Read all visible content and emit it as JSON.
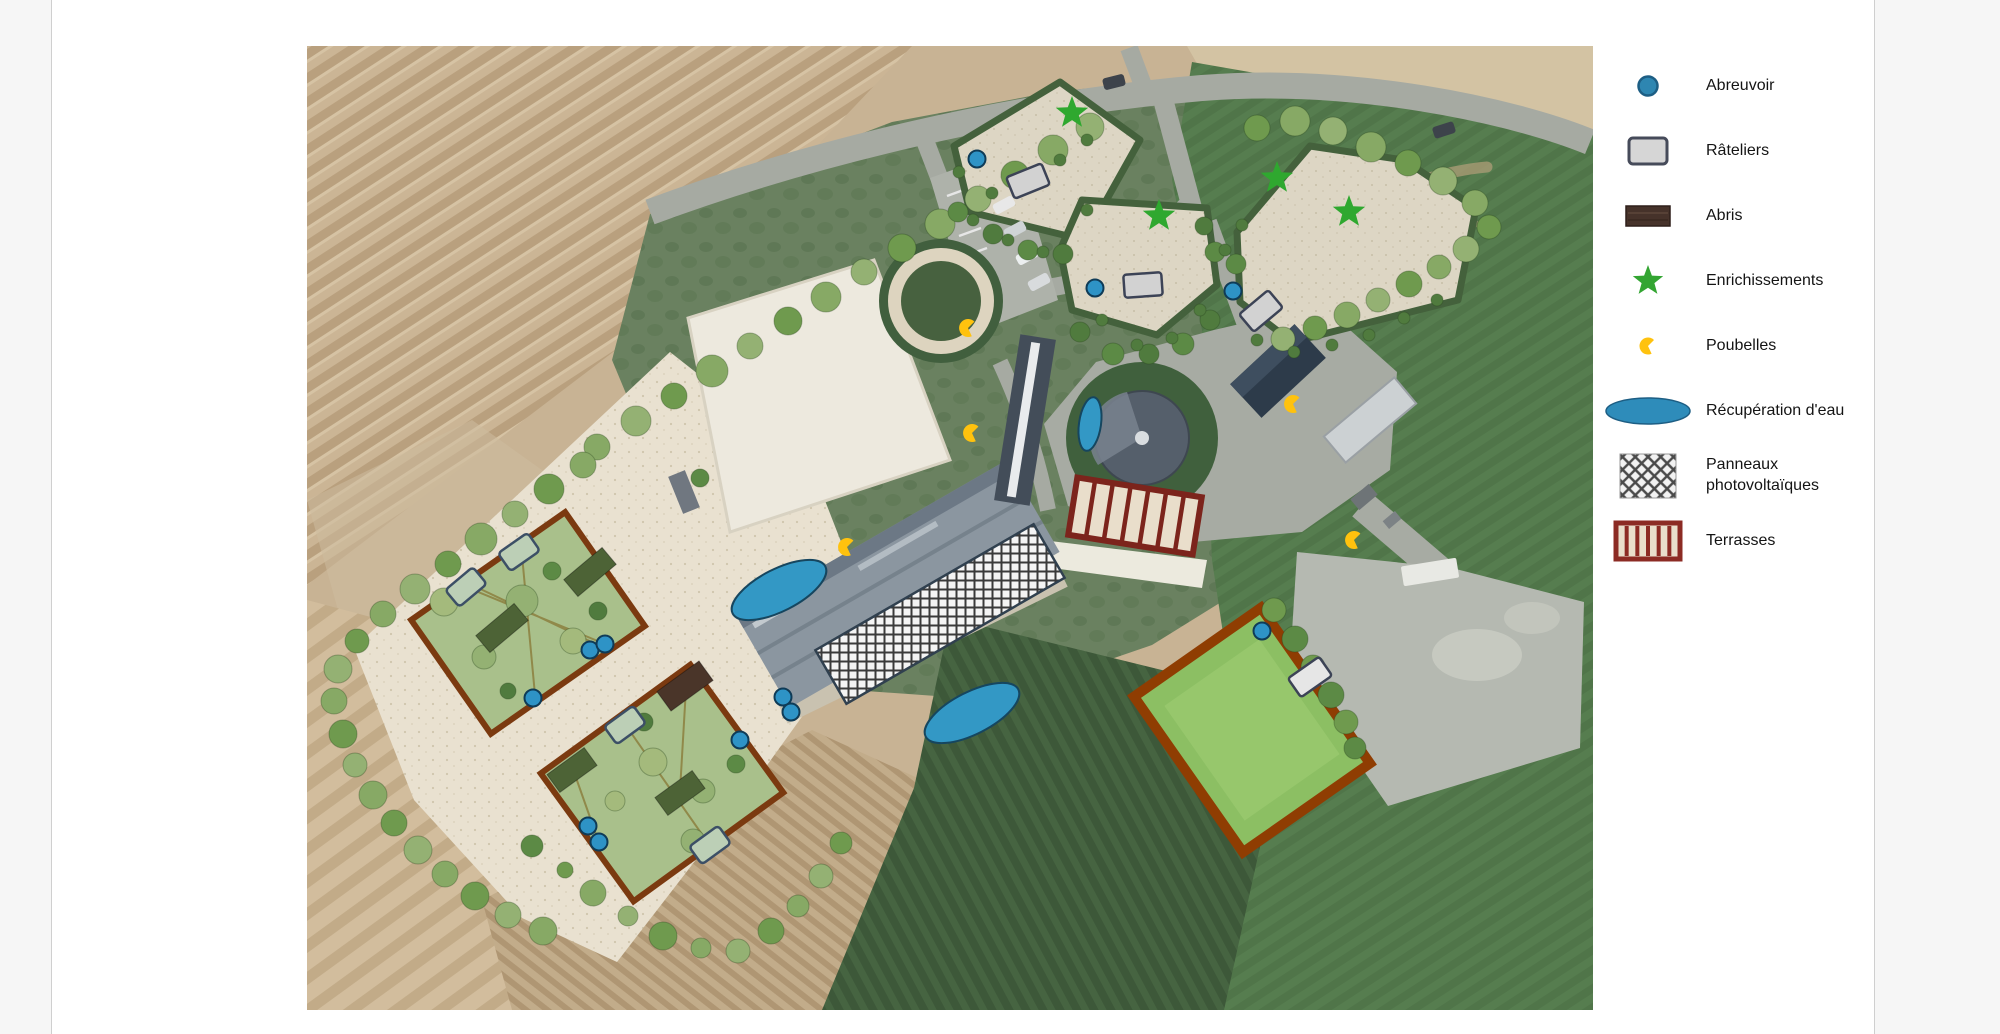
{
  "page": {
    "background": "#f6f6f6",
    "card_background": "#ffffff",
    "card_border": "#cfcfcf"
  },
  "legend": {
    "items": [
      {
        "id": "abreuvoir",
        "label": "Abreuvoir",
        "icon": "circle",
        "fill": "#2e86b1",
        "stroke": "#1d5e84"
      },
      {
        "id": "rateliers",
        "label": "Râteliers",
        "icon": "rounded-rect",
        "fill": "#d6d6d6",
        "stroke": "#464b5a"
      },
      {
        "id": "abris",
        "label": "Abris",
        "icon": "rect",
        "fill": "#46322a",
        "stroke": "#2e1f1a"
      },
      {
        "id": "enrichissements",
        "label": "Enrichissements",
        "icon": "star",
        "fill": "#33a532",
        "stroke": "#2c8f2b"
      },
      {
        "id": "poubelles",
        "label": "Poubelles",
        "icon": "pacman",
        "fill": "#ffc20e",
        "stroke": "#e0a800"
      },
      {
        "id": "recuperation-eau",
        "label": "Récupération d'eau",
        "icon": "ellipse",
        "fill": "#2e8cba",
        "stroke": "#1d5e84"
      },
      {
        "id": "panneaux-photovoltaiques",
        "label": "Panneaux photovoltaïques",
        "icon": "crosshatch",
        "fill": "#f2f2f2",
        "stroke": "#3a3a3a"
      },
      {
        "id": "terrasses",
        "label": "Terrasses",
        "icon": "stripes",
        "fill": "#e9decb",
        "stroke": "#8c2b24"
      }
    ]
  },
  "map": {
    "colors": {
      "abreuvoir_fill": "#2e93c6",
      "abreuvoir_stroke": "#0f3b57",
      "ratelier_fill": "#d2d2d2",
      "ratelier_white_fill": "#e6e6e6",
      "ratelier_stroke": "#3c4356",
      "feeder_fill": "#bccfb6",
      "feeder_stroke": "#3c4f66",
      "abri_brown": "#4a3529",
      "abri_green": "#4d6336",
      "star_fill": "#2fa82f",
      "poubelle_fill": "#ffc20e",
      "eau_fill": "#3398c5",
      "eau_stroke": "#16465f",
      "hatch_stroke": "#30404f",
      "terrasse_border": "#7c241c",
      "terrasse_fill": "#e9decb"
    },
    "markers": {
      "abreuvoirs": [
        {
          "x": 925,
          "y": 159
        },
        {
          "x": 1043,
          "y": 288
        },
        {
          "x": 1181,
          "y": 291
        },
        {
          "x": 1210,
          "y": 631
        },
        {
          "x": 731,
          "y": 697
        },
        {
          "x": 739,
          "y": 712
        },
        {
          "x": 538,
          "y": 650
        },
        {
          "x": 553,
          "y": 644
        },
        {
          "x": 481,
          "y": 698
        },
        {
          "x": 536,
          "y": 826
        },
        {
          "x": 547,
          "y": 842
        },
        {
          "x": 688,
          "y": 740
        }
      ],
      "rateliers": [
        {
          "x": 976,
          "y": 181,
          "rot": -22,
          "variant": "gray"
        },
        {
          "x": 1091,
          "y": 285,
          "rot": -4,
          "variant": "gray"
        },
        {
          "x": 1209,
          "y": 311,
          "rot": -40,
          "variant": "gray"
        },
        {
          "x": 1258,
          "y": 677,
          "rot": -35,
          "variant": "white"
        }
      ],
      "rateliers_paddock": [
        {
          "x": 467,
          "y": 552,
          "rot": -35
        },
        {
          "x": 414,
          "y": 587,
          "rot": -40
        },
        {
          "x": 573,
          "y": 725,
          "rot": -36
        },
        {
          "x": 658,
          "y": 845,
          "rot": -36
        }
      ],
      "abris": [
        {
          "x": 633,
          "y": 686,
          "rot": -36,
          "w": 52,
          "h": 24,
          "variant": "brown"
        },
        {
          "x": 538,
          "y": 572,
          "rot": -40,
          "w": 50,
          "h": 22,
          "variant": "green"
        },
        {
          "x": 450,
          "y": 628,
          "rot": -40,
          "w": 50,
          "h": 22,
          "variant": "green"
        },
        {
          "x": 520,
          "y": 770,
          "rot": -36,
          "w": 46,
          "h": 22,
          "variant": "green"
        },
        {
          "x": 628,
          "y": 793,
          "rot": -36,
          "w": 46,
          "h": 22,
          "variant": "green"
        }
      ],
      "enrichissements": [
        {
          "x": 1020,
          "y": 113
        },
        {
          "x": 1107,
          "y": 216
        },
        {
          "x": 1225,
          "y": 178
        },
        {
          "x": 1297,
          "y": 212
        }
      ],
      "poubelles": [
        {
          "x": 916,
          "y": 328
        },
        {
          "x": 920,
          "y": 433
        },
        {
          "x": 795,
          "y": 547
        },
        {
          "x": 1241,
          "y": 404
        },
        {
          "x": 1302,
          "y": 540
        }
      ],
      "recuperation_eau": [
        {
          "x": 727,
          "y": 590,
          "rx": 52,
          "ry": 21,
          "rot": -27
        },
        {
          "x": 920,
          "y": 713,
          "rx": 52,
          "ry": 21,
          "rot": -27
        },
        {
          "x": 1038,
          "y": 424,
          "rx": 11,
          "ry": 27,
          "rot": 8
        }
      ],
      "panneaux_photovoltaiques": [
        {
          "x": 888,
          "y": 614,
          "w": 252,
          "h": 62,
          "rot": -30
        }
      ],
      "terrasses": [
        {
          "x": 1083,
          "y": 516,
          "w": 126,
          "h": 58,
          "rot": 9,
          "cells": 7
        }
      ]
    },
    "tree_palette": [
      "#87a965",
      "#6f9a4e",
      "#94b173",
      "#5c8a45",
      "#a4ba7c",
      "#507b3e"
    ],
    "trees": [
      [
        545,
        447,
        13,
        0
      ],
      [
        584,
        421,
        15,
        2
      ],
      [
        622,
        396,
        13,
        1
      ],
      [
        660,
        371,
        16,
        0
      ],
      [
        698,
        346,
        13,
        2
      ],
      [
        736,
        321,
        14,
        1
      ],
      [
        774,
        297,
        15,
        0
      ],
      [
        812,
        272,
        13,
        2
      ],
      [
        850,
        248,
        14,
        1
      ],
      [
        888,
        224,
        15,
        0
      ],
      [
        926,
        199,
        13,
        2
      ],
      [
        963,
        175,
        14,
        1
      ],
      [
        1001,
        150,
        15,
        0
      ],
      [
        1038,
        127,
        14,
        2
      ],
      [
        1205,
        128,
        13,
        1
      ],
      [
        1243,
        121,
        15,
        0
      ],
      [
        1281,
        131,
        14,
        2
      ],
      [
        1319,
        147,
        15,
        0
      ],
      [
        1356,
        163,
        13,
        1
      ],
      [
        1391,
        181,
        14,
        2
      ],
      [
        1423,
        203,
        13,
        0
      ],
      [
        1437,
        227,
        12,
        1
      ],
      [
        1414,
        249,
        13,
        2
      ],
      [
        1387,
        267,
        12,
        0
      ],
      [
        1357,
        284,
        13,
        1
      ],
      [
        1326,
        300,
        12,
        2
      ],
      [
        1295,
        315,
        13,
        0
      ],
      [
        1263,
        328,
        12,
        1
      ],
      [
        1231,
        339,
        12,
        2
      ],
      [
        331,
        614,
        13,
        0
      ],
      [
        363,
        589,
        15,
        2
      ],
      [
        396,
        564,
        13,
        1
      ],
      [
        429,
        539,
        16,
        0
      ],
      [
        463,
        514,
        13,
        2
      ],
      [
        497,
        489,
        15,
        1
      ],
      [
        531,
        465,
        13,
        0
      ],
      [
        305,
        641,
        12,
        1
      ],
      [
        286,
        669,
        14,
        2
      ],
      [
        282,
        701,
        13,
        0
      ],
      [
        291,
        734,
        14,
        1
      ],
      [
        303,
        765,
        12,
        2
      ],
      [
        321,
        795,
        14,
        0
      ],
      [
        342,
        823,
        13,
        1
      ],
      [
        366,
        850,
        14,
        2
      ],
      [
        393,
        874,
        13,
        0
      ],
      [
        423,
        896,
        14,
        1
      ],
      [
        456,
        915,
        13,
        2
      ],
      [
        491,
        931,
        14,
        0
      ],
      [
        480,
        846,
        11,
        3
      ],
      [
        513,
        870,
        8,
        1
      ],
      [
        541,
        893,
        13,
        0
      ],
      [
        576,
        916,
        10,
        2
      ],
      [
        611,
        936,
        14,
        1
      ],
      [
        649,
        948,
        10,
        0
      ],
      [
        686,
        951,
        12,
        2
      ],
      [
        719,
        931,
        13,
        1
      ],
      [
        746,
        906,
        11,
        0
      ],
      [
        769,
        876,
        12,
        2
      ],
      [
        789,
        843,
        11,
        1
      ],
      [
        1222,
        610,
        12,
        1
      ],
      [
        1243,
        639,
        13,
        3
      ],
      [
        1261,
        667,
        12,
        1
      ],
      [
        1279,
        695,
        13,
        3
      ],
      [
        1294,
        722,
        12,
        1
      ],
      [
        1303,
        748,
        11,
        3
      ],
      [
        392,
        602,
        14,
        4
      ],
      [
        470,
        601,
        16,
        2
      ],
      [
        521,
        641,
        13,
        4
      ],
      [
        432,
        657,
        12,
        2
      ],
      [
        456,
        691,
        8,
        5
      ],
      [
        546,
        611,
        9,
        5
      ],
      [
        500,
        571,
        9,
        3
      ],
      [
        601,
        762,
        14,
        4
      ],
      [
        651,
        791,
        12,
        2
      ],
      [
        563,
        801,
        10,
        4
      ],
      [
        641,
        841,
        12,
        2
      ],
      [
        592,
        722,
        9,
        5
      ],
      [
        684,
        764,
        9,
        3
      ],
      [
        906,
        212,
        10,
        3
      ],
      [
        941,
        234,
        10,
        5
      ],
      [
        976,
        250,
        10,
        3
      ],
      [
        1011,
        254,
        10,
        5
      ],
      [
        1028,
        332,
        10,
        5
      ],
      [
        1061,
        354,
        11,
        3
      ],
      [
        1097,
        354,
        10,
        5
      ],
      [
        1131,
        344,
        11,
        3
      ],
      [
        1158,
        320,
        10,
        5
      ],
      [
        1163,
        252,
        10,
        3
      ],
      [
        1152,
        226,
        9,
        5
      ],
      [
        1184,
        264,
        10,
        3
      ],
      [
        921,
        220,
        6,
        5
      ],
      [
        956,
        240,
        6,
        5
      ],
      [
        991,
        252,
        6,
        5
      ],
      [
        1035,
        210,
        6,
        5
      ],
      [
        1050,
        320,
        6,
        5
      ],
      [
        1085,
        345,
        6,
        5
      ],
      [
        1120,
        338,
        6,
        5
      ],
      [
        1148,
        310,
        6,
        5
      ],
      [
        1035,
        140,
        6,
        5
      ],
      [
        1008,
        160,
        6,
        5
      ],
      [
        1173,
        250,
        6,
        5
      ],
      [
        1190,
        225,
        6,
        5
      ],
      [
        1205,
        340,
        6,
        5
      ],
      [
        1242,
        352,
        6,
        5
      ],
      [
        1280,
        345,
        6,
        5
      ],
      [
        1317,
        335,
        6,
        5
      ],
      [
        1352,
        318,
        6,
        5
      ],
      [
        1385,
        300,
        6,
        5
      ],
      [
        940,
        193,
        6,
        5
      ],
      [
        907,
        172,
        6,
        5
      ],
      [
        648,
        478,
        9,
        3
      ]
    ]
  }
}
